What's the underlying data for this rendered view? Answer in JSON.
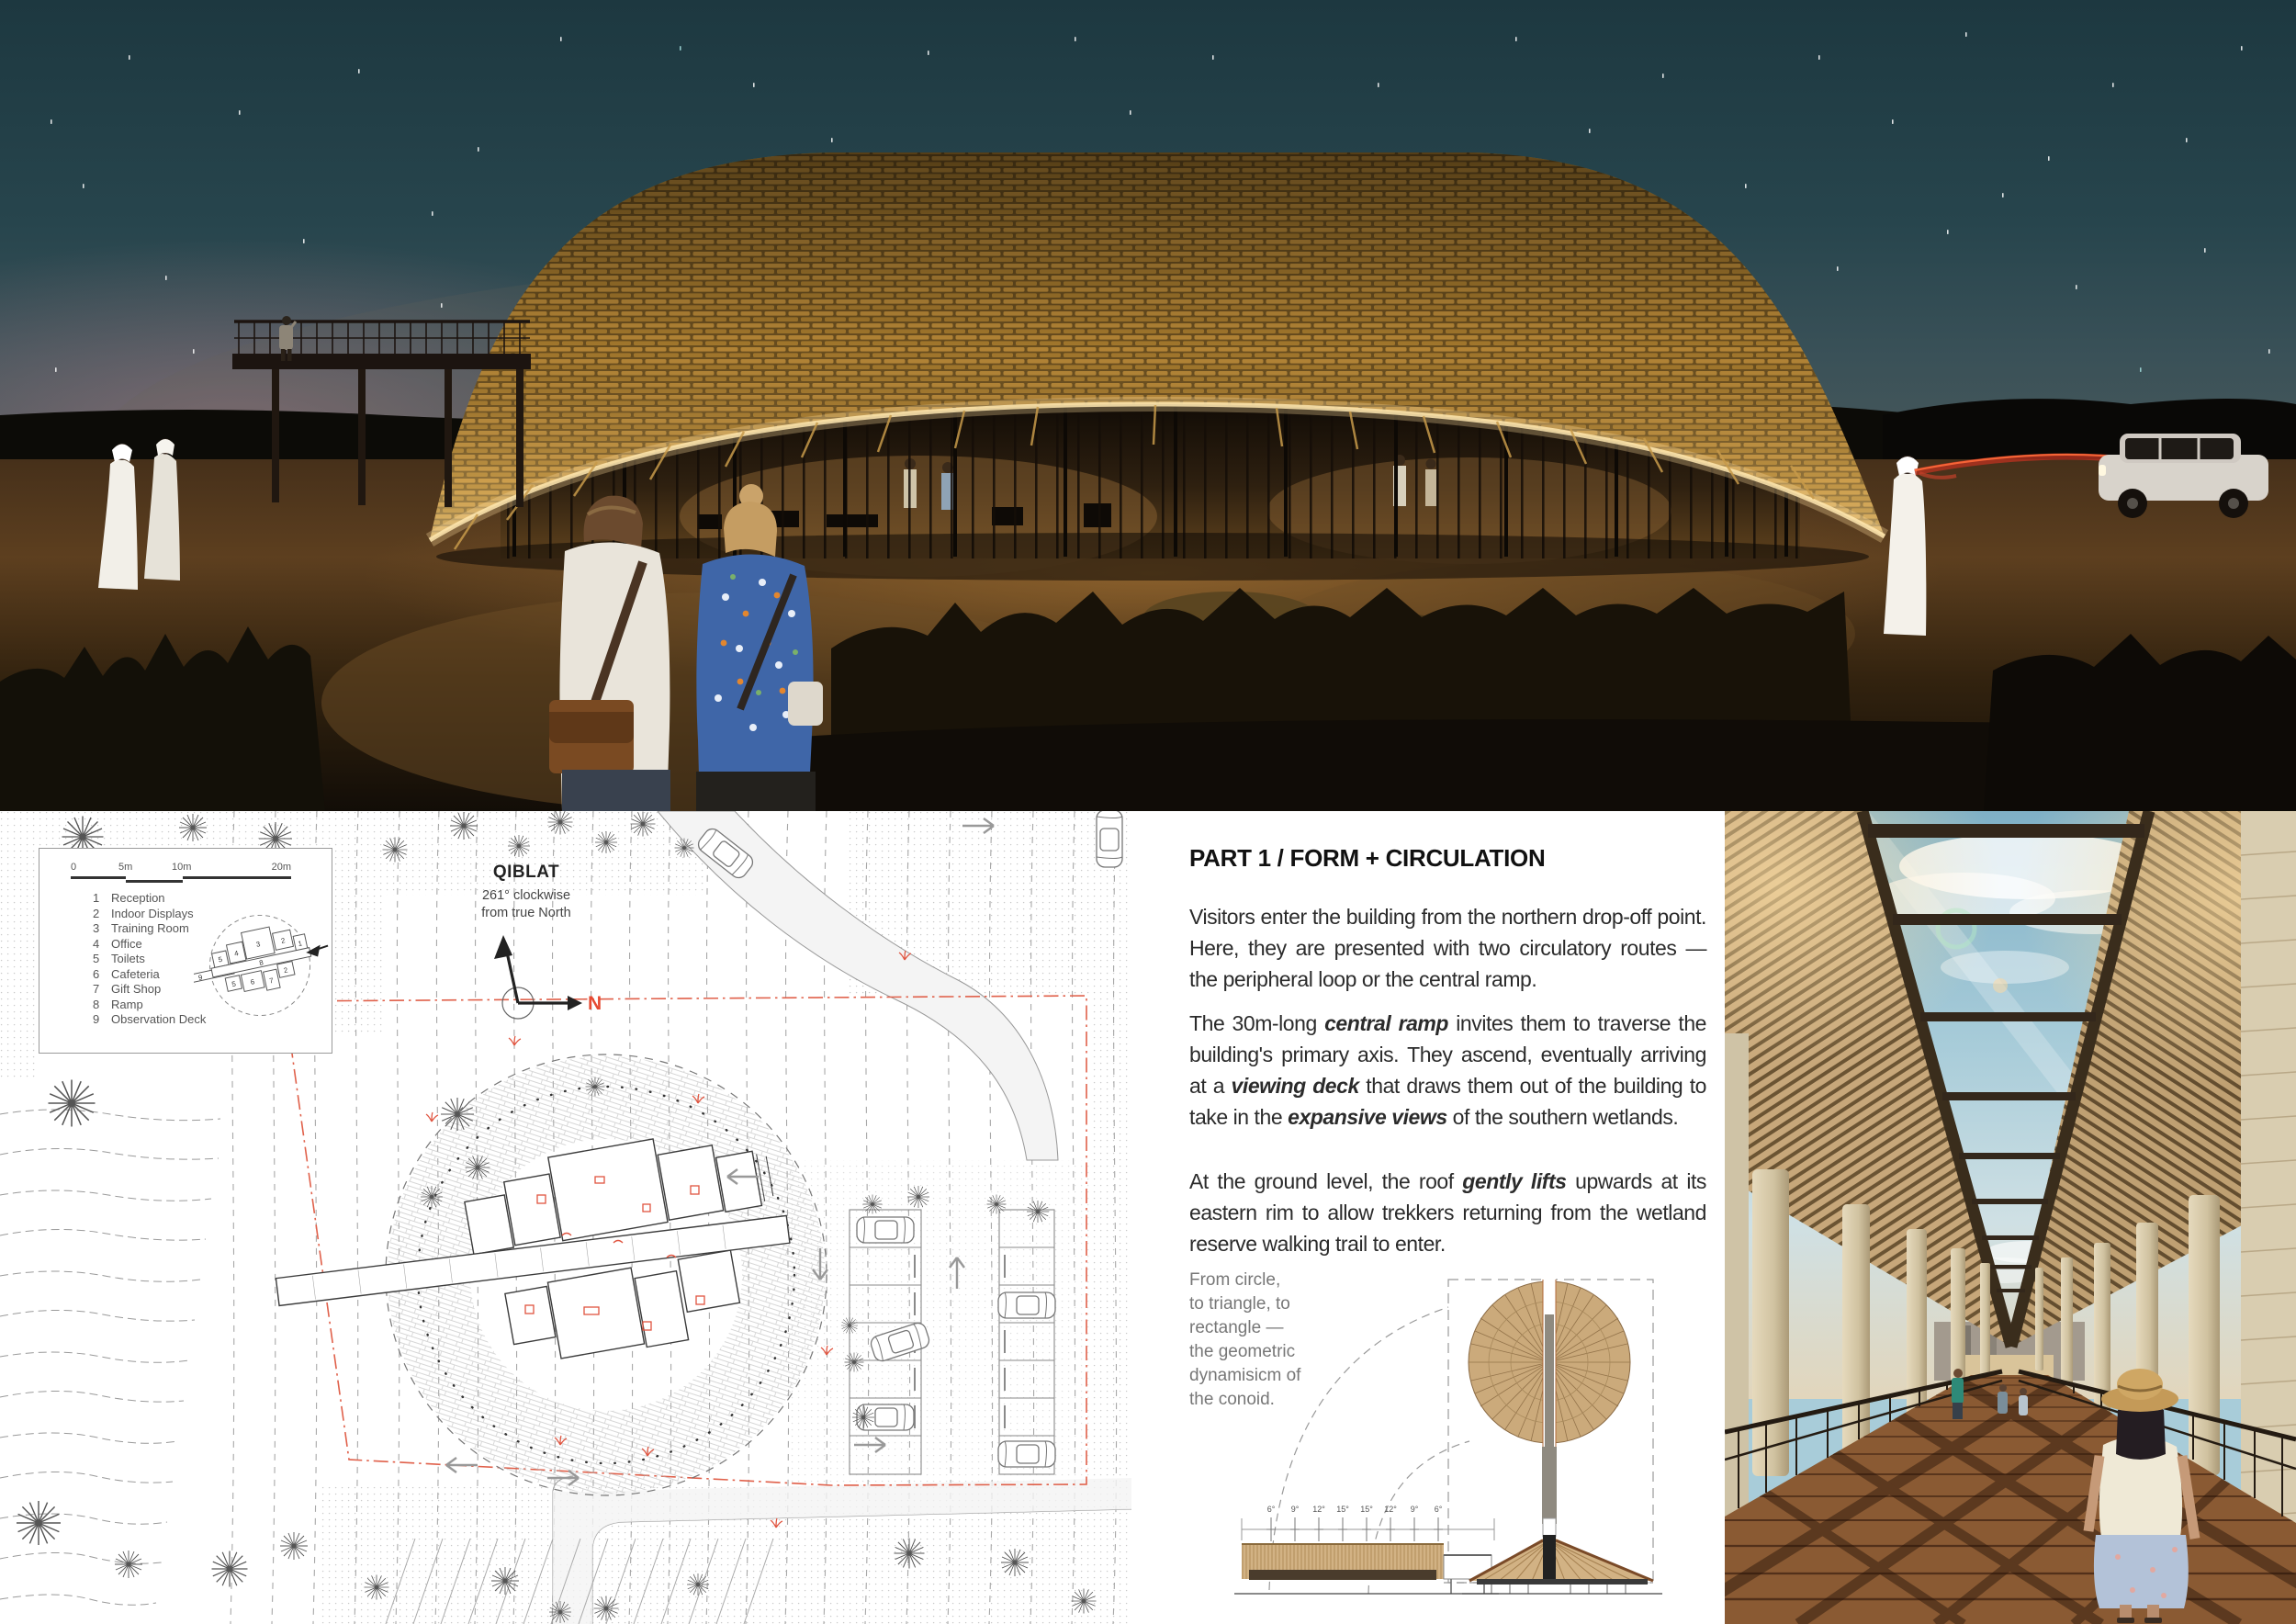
{
  "palette": {
    "accent_red": "#e64b33",
    "plan_line_red": "#e0604a",
    "roof_gold": "#bb8a38",
    "eave_glow": "#ffdf9e",
    "night_sky_teal": "#27454d",
    "day_sky_blue": "#a8ccd9",
    "timber_tan": "#c7a77a",
    "deck_brown": "#8a5a33"
  },
  "siteplan": {
    "scale_labels": [
      "0",
      "5m",
      "10m",
      "20m"
    ],
    "legend": [
      {
        "num": "1",
        "label": "Reception"
      },
      {
        "num": "2",
        "label": "Indoor Displays"
      },
      {
        "num": "3",
        "label": "Training Room"
      },
      {
        "num": "4",
        "label": "Office"
      },
      {
        "num": "5",
        "label": "Toilets"
      },
      {
        "num": "6",
        "label": "Cafeteria"
      },
      {
        "num": "7",
        "label": "Gift Shop"
      },
      {
        "num": "8",
        "label": "Ramp"
      },
      {
        "num": "9",
        "label": "Observation Deck"
      }
    ],
    "keyplan_numbers": [
      "5",
      "4",
      "3",
      "2",
      "1",
      "9",
      "8",
      "5",
      "6",
      "7",
      "2"
    ],
    "qiblat": {
      "title": "QIBLAT",
      "note": "261° clockwise\nfrom true North",
      "north": "N"
    }
  },
  "article": {
    "heading": "PART 1 / FORM + CIRCULATION",
    "p1": "Visitors enter the building from the northern drop-off point. Here, they are presented with two circulatory routes — the peripheral loop or the central ramp.",
    "p2": [
      "The 30m-long ",
      "central ramp",
      " invites them to traverse the building's primary axis. They ascend, eventually arriving at a ",
      "viewing deck",
      " that draws them out of the building to take in the ",
      "expansive views",
      " of the southern wetlands."
    ],
    "p3": [
      "At the ground level, the roof ",
      "gently lifts",
      " upwards at its eastern rim to allow trekkers returning from the wetland reserve walking trail to enter."
    ],
    "caption": "From circle,\nto triangle, to\nrectangle —\nthe geometric\ndynamisicm of\nthe conoid."
  },
  "diagram": {
    "angles": [
      "6°",
      "9°",
      "12°",
      "15°",
      "15°",
      "12°",
      "9°",
      "6°"
    ]
  }
}
